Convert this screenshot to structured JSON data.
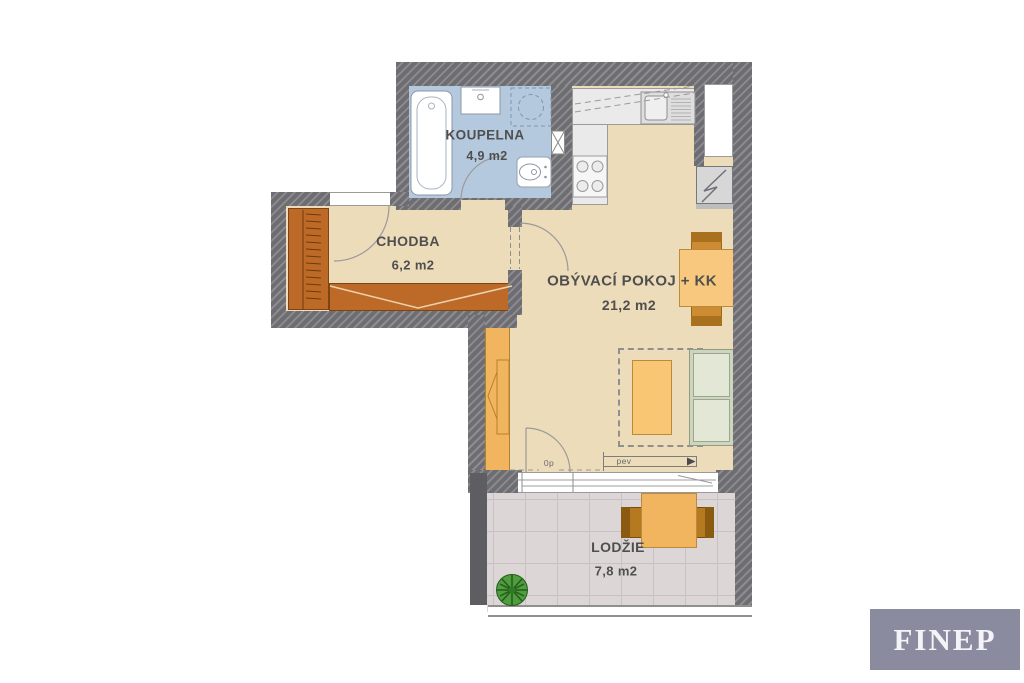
{
  "floorplan": {
    "rooms": {
      "koupelna": {
        "label": "KOUPELNA",
        "area": "4,9 m2"
      },
      "chodba": {
        "label": "CHODBA",
        "area": "6,2 m2"
      },
      "obyvaci_pokoj": {
        "label": "OBÝVACÍ POKOJ + KK",
        "area": "21,2 m2"
      },
      "lodzie": {
        "label": "LODŽIE",
        "area": "7,8 m2"
      }
    },
    "annotations": {
      "threshold": "0p",
      "fixed_window": "pev"
    },
    "colors": {
      "wall": "#6e6e72",
      "floor": "#ecdcba",
      "bathroom_floor": "#b5c9de",
      "balcony_floor": "#dcd6d7",
      "furniture_wood": "#bd6a28",
      "accent_orange": "#f2b55f",
      "sofa_green": "#e2e7d6",
      "logo_bg": "#8b8ba0"
    }
  },
  "branding": {
    "logo": "FINEP"
  }
}
